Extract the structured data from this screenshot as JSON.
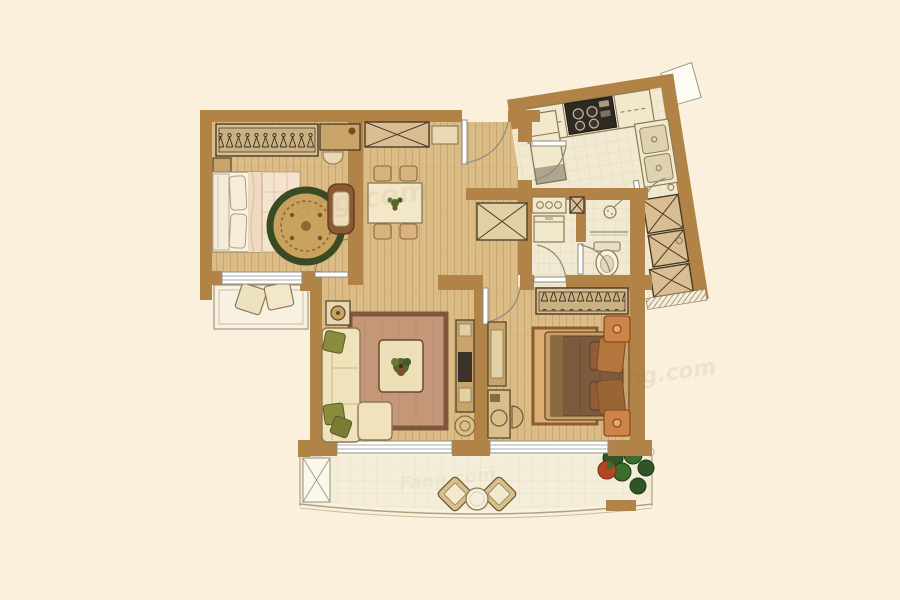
{
  "title": "apartment-floor-plan",
  "watermark": {
    "text": "Fang.com"
  },
  "colors": {
    "background": "#FAF0DC",
    "wall": "#B18347",
    "wall_dark": "#8A6230",
    "wood_floor": "#DCBC86",
    "wood_line": "#C9A76C",
    "tile_floor": "#F1E9D1",
    "tile_line": "#E2D7B6",
    "balcony_floor": "#F4EDDA",
    "balcony_line": "#E8DEC2",
    "furniture_tan": "#D8BE92",
    "furniture_dark": "#4A3B26",
    "furniture_mid": "#C9A46A",
    "cream": "#F2E8CC",
    "line_mid": "#8A7A55",
    "bed_frame": "#F8F2E4",
    "bed_cream": "#F4E4CE",
    "blanket": "#EFD9C2",
    "duvet_brown": "#7B5B3E",
    "duvet_edge": "#5A4028",
    "pillow_orange": "#B5763E",
    "pillow_orange_dark": "#8F5E38",
    "rug_ring_green": "#3A4A22",
    "rug_tan": "#C9A25E",
    "rug_living": "#C49779",
    "rug_living_border": "#7E573C",
    "rug_bedroom2": "#DCAE72",
    "sofa_cream": "#F0E2BB",
    "pillow_green": "#8A8C3C",
    "nightstand_orange": "#CE8348",
    "stove_dark": "#2E2A22",
    "plant_green": "#2F5526",
    "plant_green_light": "#3E6B2E",
    "plant_red": "#B3471F",
    "door_line": "#8C8C7C",
    "window_line": "#8F8F85",
    "watermark": "#8A6D3B",
    "white": "#FDFBF2"
  },
  "rooms": [
    {
      "id": "master-bedroom",
      "contents": [
        "wardrobe-with-hangers",
        "double-bed",
        "round-rug",
        "armchair",
        "nightstand",
        "dresser",
        "stool"
      ]
    },
    {
      "id": "bay-window",
      "contents": [
        "cushions"
      ]
    },
    {
      "id": "dining-area",
      "contents": [
        "dining-table",
        "four-chairs",
        "sideboard",
        "shelf"
      ]
    },
    {
      "id": "entry",
      "contents": [
        "entry-door"
      ]
    },
    {
      "id": "kitchen",
      "contents": [
        "counter",
        "gas-stove",
        "double-sink",
        "fridge",
        "upper-cabinets"
      ]
    },
    {
      "id": "service-corridor",
      "contents": [
        "storage-cabinets",
        "ac-platform"
      ]
    },
    {
      "id": "laundry-hall",
      "contents": [
        "basin-counter",
        "washing-machine",
        "storage-box"
      ]
    },
    {
      "id": "bathroom",
      "contents": [
        "toilet",
        "shower",
        "glass-screen"
      ]
    },
    {
      "id": "living-room",
      "contents": [
        "l-sofa",
        "area-rug",
        "coffee-table",
        "tv-cabinet",
        "side-table",
        "pouf"
      ]
    },
    {
      "id": "second-bedroom",
      "contents": [
        "wardrobe-with-hangers",
        "double-bed",
        "rug",
        "two-nightstands",
        "desk",
        "vanity",
        "stool"
      ]
    },
    {
      "id": "balcony",
      "contents": [
        "two-chairs",
        "round-table",
        "plants",
        "storage-cabinet",
        "curved-railing"
      ]
    }
  ]
}
